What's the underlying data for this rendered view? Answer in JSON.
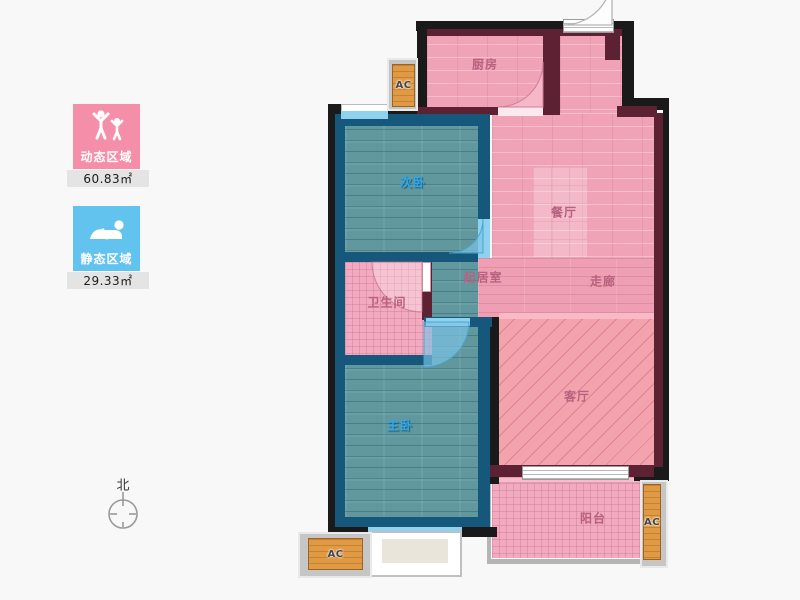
{
  "legend": {
    "dynamic": {
      "label": "动态区域",
      "area": "60.83㎡",
      "color": "#f58fa9",
      "icon": "people-active-icon"
    },
    "static_zone": {
      "label": "静态区域",
      "area": "29.33㎡",
      "color": "#63c3ef",
      "icon": "person-resting-icon"
    }
  },
  "compass": {
    "north_label": "北"
  },
  "rooms": {
    "kitchen": {
      "label": "厨房"
    },
    "dining": {
      "label": "餐厅"
    },
    "bedroom_second": {
      "label": "次卧"
    },
    "living_core": {
      "label": "起居室"
    },
    "corridor": {
      "label": "走廊"
    },
    "bathroom": {
      "label": "卫生间"
    },
    "bedroom_master": {
      "label": "主卧"
    },
    "living": {
      "label": "客厅"
    },
    "balcony": {
      "label": "阳台"
    }
  },
  "ac_unit": {
    "label": "AC"
  },
  "colors": {
    "wall_outer": "#1a1a1a",
    "wall_inner_pink_zone": "#5c2133",
    "wall_inner_blue_zone": "#15587c",
    "floor_pink": "#f0a2b7",
    "floor_teal": "#60989e",
    "hatch_salmon": "#f3a3ad",
    "window_blue": "#8fd2f0",
    "ac_orange": "#e09a43",
    "label_pink": "#b7617e",
    "label_blue": "#31a8ea"
  }
}
